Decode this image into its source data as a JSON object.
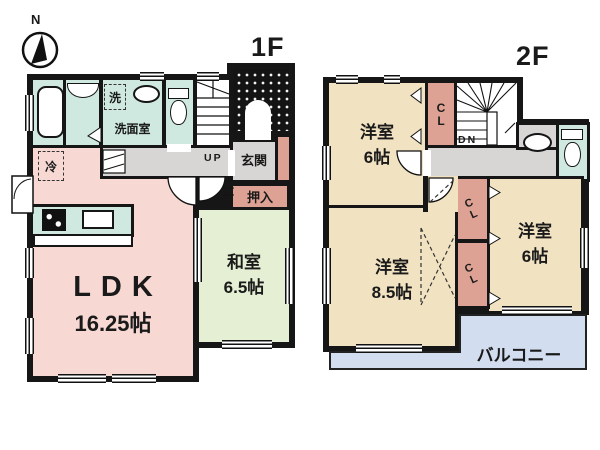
{
  "compass": {
    "north_label": "N"
  },
  "floor1": {
    "label": "1F",
    "stairs_label": "UP",
    "rooms": {
      "ldk": {
        "name": "LDK",
        "size": "16.25帖"
      },
      "washitsu": {
        "name": "和室",
        "size": "6.5帖"
      },
      "genkan": {
        "name": "玄関"
      },
      "oshiire": {
        "name": "押入"
      },
      "senmen": {
        "name": "洗面室"
      },
      "laundry": {
        "name": "洗"
      },
      "fridge": {
        "name": "冷"
      }
    }
  },
  "floor2": {
    "label": "2F",
    "stairs_label": "DN",
    "rooms": {
      "bedroom_nw": {
        "name": "洋室",
        "size": "6帖"
      },
      "bedroom_sw": {
        "name": "洋室",
        "size": "8.5帖"
      },
      "bedroom_se": {
        "name": "洋室",
        "size": "6帖"
      },
      "balcony": {
        "name": "バルコニー"
      },
      "closet_top": {
        "name": "CL"
      },
      "closet_mid1": {
        "name": "CL"
      },
      "closet_mid2": {
        "name": "CL"
      }
    }
  },
  "colors": {
    "wall": "#161616",
    "wet_area": "#cfe9e0",
    "ldk_pink": "#f7d8d3",
    "tatami_green": "#e4efd3",
    "bedroom_tan": "#f1e2c1",
    "closet_salmon": "#dda294",
    "hallway_gray": "#d7d6d4",
    "balcony_blue": "#d2ddef",
    "porch_black": "#141414"
  }
}
